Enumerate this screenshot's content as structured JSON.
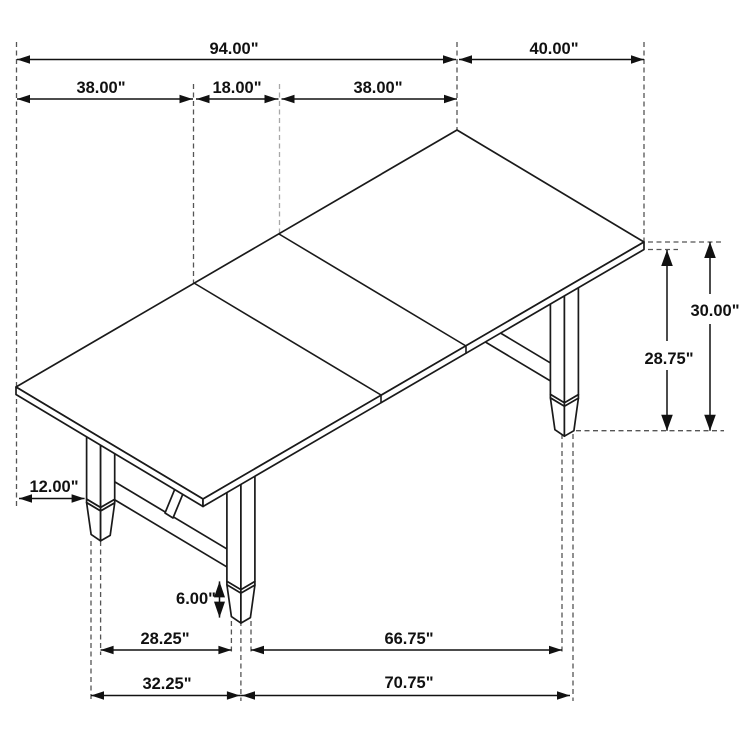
{
  "figure": {
    "kind": "isometric furniture dimension drawing",
    "subject": "rectangular trestle dining table with center extension leaf",
    "background_color": "#ffffff",
    "line_color": "#1a1a1a",
    "text_color": "#111111"
  },
  "dims": {
    "overall_length": "94.00\"",
    "table_width": "40.00\"",
    "left_section": "38.00\"",
    "leaf_section": "18.00\"",
    "right_section": "38.00\"",
    "height_to_top": "30.00\"",
    "height_to_underside": "28.75\"",
    "leg_inset": "12.00\"",
    "foot_height": "6.00\"",
    "foot_span_inner_left": "28.25\"",
    "foot_span_inner_right": "66.75\"",
    "foot_span_outer_left": "32.25\"",
    "foot_span_outer_right": "70.75\""
  }
}
